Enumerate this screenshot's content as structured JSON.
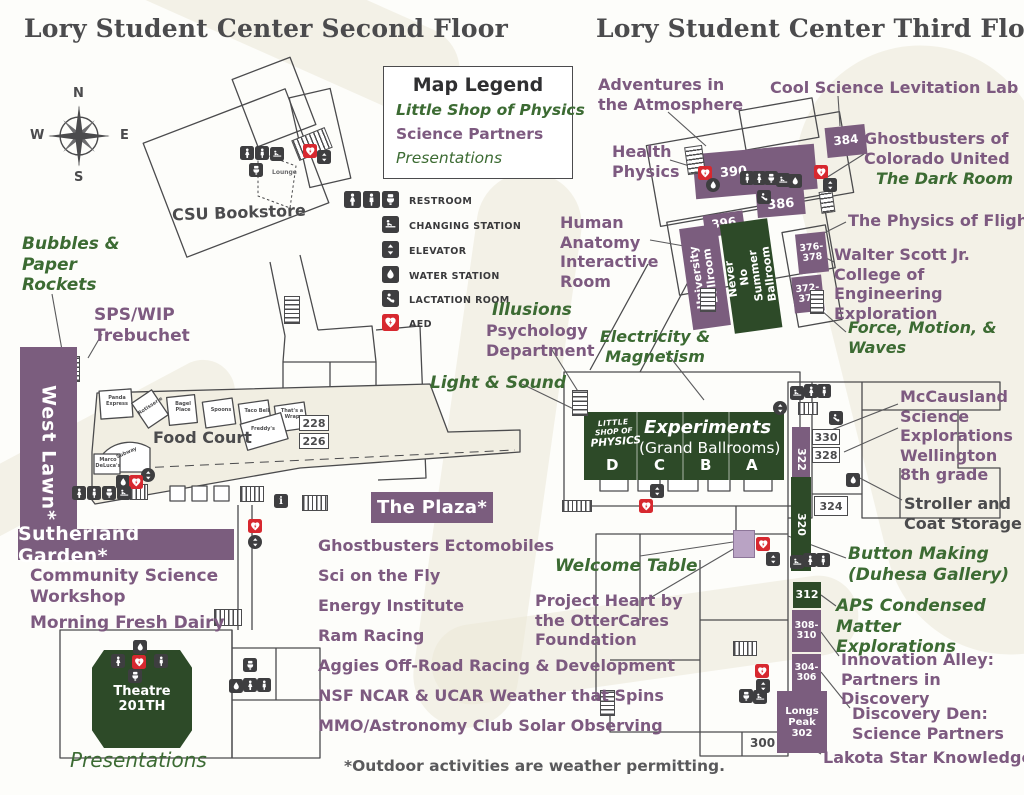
{
  "colors": {
    "purple_block": "#7b5d7e",
    "purple_light": "#b9a3c4",
    "green_block": "#2d4a28",
    "green_text": "#3c6b33",
    "purple_text": "#7d5a80",
    "dark_text": "#4b4b4d",
    "icon_dark": "#3e3e40",
    "aed_red": "#d7282f",
    "wash_beige": "#ebe8d7"
  },
  "titles": {
    "second_floor": "Lory Student Center Second Floor",
    "third_floor": "Lory Student Center Third Floor"
  },
  "compass": {
    "north": "N",
    "east": "E",
    "south": "S",
    "west": "W"
  },
  "legend": {
    "title": "Map Legend",
    "category_lsop": "Little Shop of Physics",
    "category_partners": "Science Partners",
    "category_presentations": "Presentations",
    "facilities": [
      "RESTROOM",
      "CHANGING STATION",
      "ELEVATOR",
      "WATER STATION",
      "LACTATION ROOM",
      "AED"
    ]
  },
  "floor2": {
    "bookstore": "CSU Bookstore",
    "lounge": "Lounge",
    "food_court": "Food Court",
    "stalls": {
      "panda": "Panda Express",
      "rotisserie": "Rotisserie",
      "bagel": "Bagel Place",
      "spoons": "Spoons",
      "taco": "Taco Bell",
      "wrap": "That's a Wrap",
      "freddys": "Freddy's",
      "subway": "Subway",
      "deluca": "Marco DeLuca's"
    },
    "rooms": {
      "r228": "228",
      "r226": "226"
    },
    "banners": {
      "west_lawn": "West Lawn*",
      "sutherland": "Sutherland Garden*",
      "plaza": "The Plaza*"
    },
    "labels": {
      "bubbles": "Bubbles & Paper Rockets",
      "sps": "SPS/WIP Trebuchet",
      "community": "Community Science Workshop",
      "dairy": "Morning Fresh Dairy",
      "theatre": "Theatre 201TH",
      "presentations": "Presentations"
    },
    "activities": [
      "Ghostbusters Ectomobiles",
      "Sci on the Fly",
      "Energy Institute",
      "Ram Racing",
      "Aggies Off-Road Racing & Development",
      "NSF NCAR & UCAR Weather that Spins",
      "MMO/Astronomy Club Solar Observing"
    ],
    "footnote": "*Outdoor activities are weather permitting."
  },
  "floor3": {
    "labels": {
      "adventures": "Adventures in the Atmosphere",
      "cool": "Cool Science Levitation Lab",
      "health": "Health Physics",
      "ghostbusters": "Ghostbusters of Colorado United",
      "darkroom": "The Dark Room",
      "anatomy": "Human Anatomy Interactive Room",
      "flight": "The Physics of Flight",
      "walter": "Walter Scott Jr. College of Engineering Exploration",
      "illusions": "Illusions",
      "psychology": "Psychology Department",
      "electricity": "Electricity & Magnetism",
      "light": "Light & Sound",
      "force": "Force, Motion, & Waves",
      "mccausland": "McCausland Science Explorations Wellington 8th grade",
      "stroller": "Stroller and Coat Storage",
      "button": "Button Making (Duhesa Gallery)",
      "aps": "APS Condensed Matter Explorations",
      "innovation": "Innovation Alley: Partners in Discovery",
      "discovery": "Discovery Den: Science Partners",
      "lakota": "Lakota Star Knowledge",
      "welcome": "Welcome Table",
      "project": "Project Heart by the OtterCares Foundation"
    },
    "ballrooms": {
      "logo_line1": "LITTLE",
      "logo_line2": "SHOP OF",
      "logo_line3": "PHYSICS",
      "experiments": "Experiments",
      "grand": "(Grand Ballrooms)",
      "sections": [
        "D",
        "C",
        "B",
        "A"
      ],
      "university": "University Ballroom",
      "never_no": "Never No Summer Ballroom"
    },
    "rooms": {
      "r384": "384",
      "r390": "390",
      "r386": "386",
      "r396": "396",
      "r376": "376-378",
      "r372": "372-374",
      "r322": "322",
      "r330": "330",
      "r328": "328",
      "r320": "320",
      "r324": "324",
      "r312": "312",
      "r308": "308-310",
      "r304": "304-306",
      "longs": "Longs Peak 302",
      "r300": "300"
    }
  }
}
